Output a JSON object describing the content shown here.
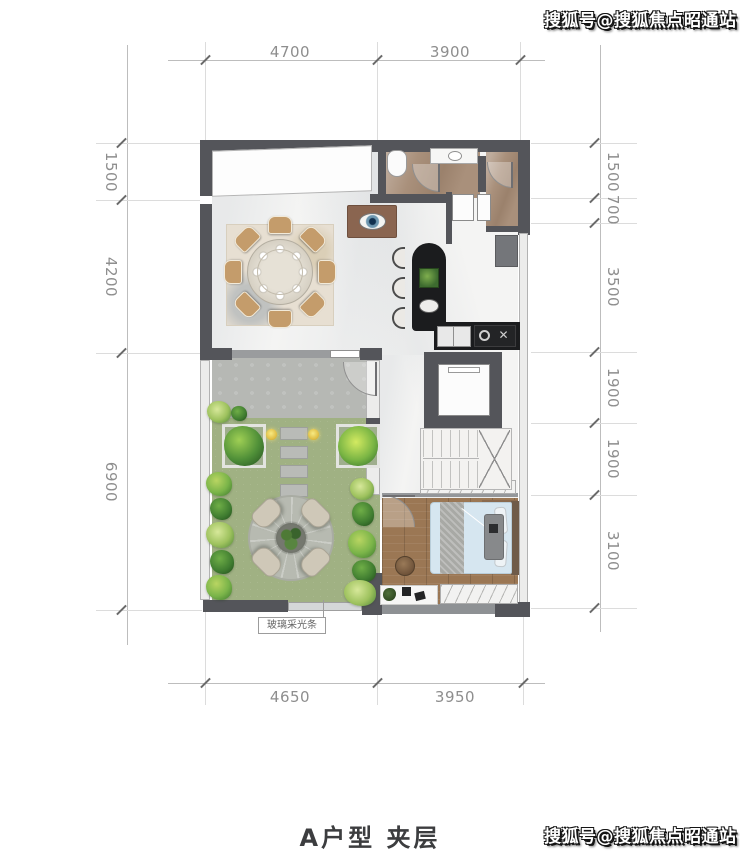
{
  "watermark": {
    "text": "搜狐号@搜狐焦点昭通站"
  },
  "title": "A户型 夹层",
  "plan": {
    "annotation": "玻璃采光条",
    "dimensions": {
      "top": [
        "4700",
        "3900"
      ],
      "bottom": [
        "4650",
        "3950"
      ],
      "left": [
        "1500",
        "4200",
        "6900"
      ],
      "right": [
        "1500",
        "700",
        "3500",
        "1900",
        "1900",
        "3100"
      ]
    }
  },
  "colors": {
    "wall": "#54555a",
    "lawn": "#a0b183",
    "stone": "#b6b8b4",
    "wood": "#9b7754",
    "counter": "#1b1c1e",
    "bed_blue": "#d6e6f0",
    "bath_marble": "#a9907b",
    "dim_text": "#8e8e8e",
    "watermark_fill": "#ffffff",
    "watermark_outline": "#141414"
  }
}
